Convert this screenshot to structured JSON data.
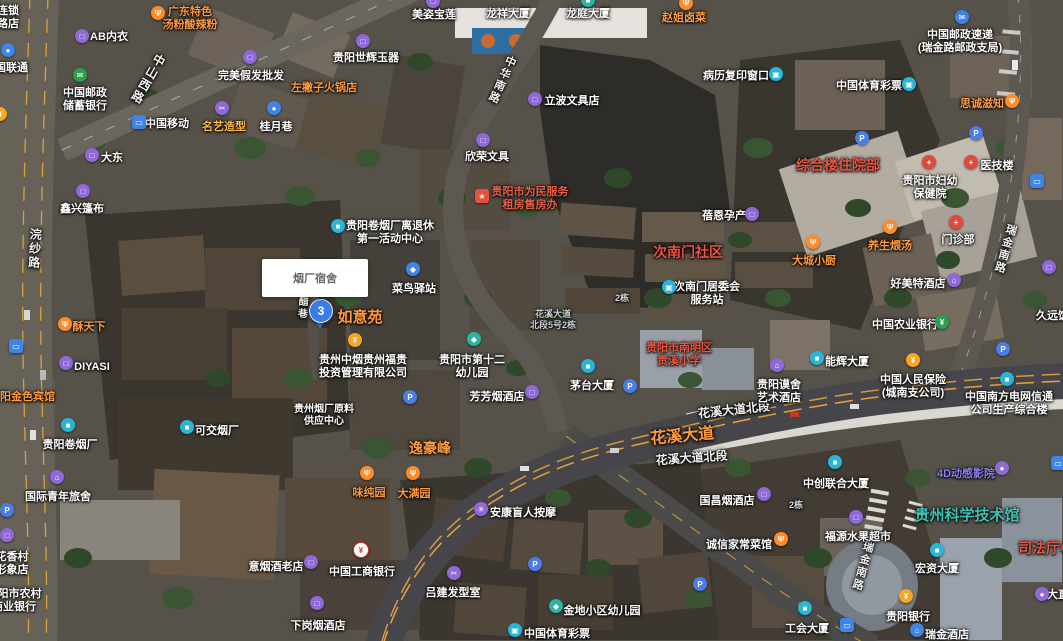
{
  "info_box": {
    "text": "烟厂宿舍"
  },
  "marker": {
    "label": "3"
  },
  "colors": {
    "poi_orange": "#ff9a3d",
    "area_red": "#e8543f",
    "science_teal": "#3cc2b4",
    "marker_blue": "#3a7de8",
    "road_orange": "#e8a23c"
  },
  "road_labels": [
    {
      "text": "中山西路",
      "x": 162,
      "y": 55,
      "rot": 30,
      "vert": true,
      "size": 12
    },
    {
      "text": "中华南路",
      "x": 512,
      "y": 56,
      "rot": 24,
      "vert": true,
      "size": 11
    },
    {
      "text": "浣纱路",
      "x": 36,
      "y": 228,
      "rot": 3,
      "vert": true,
      "size": 12
    },
    {
      "text": "酱醋巷",
      "x": 303,
      "y": 284,
      "rot": 4,
      "vert": true,
      "size": 10
    },
    {
      "text": "瑞金南路",
      "x": 1012,
      "y": 224,
      "rot": 16,
      "vert": true,
      "size": 11
    },
    {
      "text": "瑞金南路",
      "x": 869,
      "y": 541,
      "rot": 15,
      "vert": true,
      "size": 11
    },
    {
      "text": "花溪大道北段",
      "x": 733,
      "y": 401,
      "rot": -6,
      "vert": false,
      "size": 12
    },
    {
      "text": "花溪大道",
      "x": 681,
      "y": 422,
      "rot": -5,
      "vert": false,
      "size": 16,
      "color": "#ff9a3d"
    },
    {
      "text": "花溪大道北段",
      "x": 691,
      "y": 449,
      "rot": -4,
      "vert": false,
      "size": 12
    }
  ],
  "pois": [
    {
      "t": [
        "连锁",
        "路店"
      ],
      "x": 8,
      "y": 5
    },
    {
      "t": [
        "AB内衣"
      ],
      "x": 109,
      "y": 31,
      "icon": {
        "g": "□",
        "bg": "#9068d8",
        "x": 82,
        "y": 36
      }
    },
    {
      "t": [
        "广东特色",
        "汤粉酸辣粉"
      ],
      "x": 190,
      "y": 6,
      "c": "#ff9a3d",
      "icon": {
        "g": "Ψ",
        "bg": "#ff8c28",
        "x": 158,
        "y": 13
      }
    },
    {
      "t": [
        "中国联通"
      ],
      "x": 6,
      "y": 62,
      "icon": {
        "g": "●",
        "bg": "#3f85e8",
        "x": 8,
        "y": 50
      }
    },
    {
      "t": [
        "中国邮政",
        "储蓄银行"
      ],
      "x": 85,
      "y": 87,
      "icon": {
        "g": "✉",
        "bg": "#2e9e4f",
        "x": 80,
        "y": 75
      }
    },
    {
      "t": [
        "大东"
      ],
      "x": 112,
      "y": 152,
      "icon": {
        "g": "□",
        "bg": "#9068d8",
        "x": 92,
        "y": 155
      }
    },
    {
      "t": [
        "鑫兴篷布"
      ],
      "x": 82,
      "y": 203,
      "icon": {
        "g": "□",
        "bg": "#9068d8",
        "x": 83,
        "y": 191
      }
    },
    {
      "t": [
        "完美假发批发"
      ],
      "x": 251,
      "y": 70,
      "icon": {
        "g": "□",
        "bg": "#9068d8",
        "x": 250,
        "y": 57
      }
    },
    {
      "t": [
        "左撇子火锅店"
      ],
      "x": 324,
      "y": 82,
      "c": "#ff9a3d"
    },
    {
      "t": [
        "名艺造型"
      ],
      "x": 224,
      "y": 121,
      "c": "#ffb84a",
      "icon": {
        "g": "✂",
        "bg": "#9068d8",
        "x": 222,
        "y": 108
      }
    },
    {
      "t": [
        "桂月巷"
      ],
      "x": 276,
      "y": 121,
      "icon": {
        "g": "●",
        "bg": "#3f85e8",
        "x": 274,
        "y": 108
      }
    },
    {
      "t": [
        "中国移动"
      ],
      "x": 167,
      "y": 118,
      "icon": {
        "g": "▭",
        "bg": "#3f85e8",
        "x": 139,
        "y": 122,
        "sq": true
      }
    },
    {
      "t": [
        "贵阳世辉玉器"
      ],
      "x": 366,
      "y": 52,
      "icon": {
        "g": "□",
        "bg": "#9068d8",
        "x": 363,
        "y": 41
      }
    },
    {
      "t": [
        "美姿宝莲"
      ],
      "x": 434,
      "y": 9,
      "icon": {
        "g": "□",
        "bg": "#9068d8",
        "x": 433,
        "y": 1
      }
    },
    {
      "t": [
        "龙祥大厦"
      ],
      "x": 508,
      "y": 8
    },
    {
      "t": [
        "龙庭大厦"
      ],
      "x": 588,
      "y": 8,
      "icon": {
        "g": "■",
        "bg": "#2bb3a3",
        "x": 588,
        "y": 0
      }
    },
    {
      "t": [
        "赵姐卤菜"
      ],
      "x": 684,
      "y": 12,
      "c": "#ff9a3d",
      "icon": {
        "g": "Ψ",
        "bg": "#ff8c28",
        "x": 686,
        "y": 3
      }
    },
    {
      "t": [
        "欣荣文具"
      ],
      "x": 487,
      "y": 151,
      "icon": {
        "g": "□",
        "bg": "#9068d8",
        "x": 483,
        "y": 140
      }
    },
    {
      "t": [
        "立波文具店"
      ],
      "x": 572,
      "y": 95,
      "icon": {
        "g": "□",
        "bg": "#9068d8",
        "x": 535,
        "y": 99
      }
    },
    {
      "t": [
        "病历复印窗口"
      ],
      "x": 736,
      "y": 70,
      "icon": {
        "g": "▣",
        "bg": "#2ab5d8",
        "x": 776,
        "y": 74
      }
    },
    {
      "t": [
        "中国邮政速递",
        "(瑞金路邮政支局)"
      ],
      "x": 960,
      "y": 29,
      "icon": {
        "g": "✉",
        "bg": "#3f85e8",
        "x": 962,
        "y": 17
      }
    },
    {
      "t": [
        "中国体育彩票"
      ],
      "x": 869,
      "y": 80,
      "icon": {
        "g": "▣",
        "bg": "#2ab5d8",
        "x": 909,
        "y": 84
      }
    },
    {
      "t": [
        "思诚滋知"
      ],
      "x": 982,
      "y": 98,
      "c": "#ff9a3d",
      "icon": {
        "g": "Ψ",
        "bg": "#ff8c28",
        "x": 1012,
        "y": 101
      }
    },
    {
      "icon": {
        "g": "P",
        "bg": "#4a7de8",
        "x": 862,
        "y": 138
      }
    },
    {
      "icon": {
        "g": "P",
        "bg": "#4a7de8",
        "x": 976,
        "y": 133
      }
    },
    {
      "t": [
        "综合楼住院部"
      ],
      "x": 838,
      "y": 157,
      "c": "#e8543f",
      "s": 14
    },
    {
      "t": [
        "贵阳市妇幼",
        "保健院"
      ],
      "x": 930,
      "y": 175,
      "icon": {
        "g": "+",
        "bg": "#e2483c",
        "x": 929,
        "y": 162
      }
    },
    {
      "t": [
        "医技楼"
      ],
      "x": 997,
      "y": 160,
      "icon": {
        "g": "+",
        "bg": "#e2483c",
        "x": 971,
        "y": 162
      }
    },
    {
      "t": [
        "蓓恩孕产"
      ],
      "x": 724,
      "y": 210,
      "icon": {
        "g": "□",
        "bg": "#9068d8",
        "x": 752,
        "y": 214
      }
    },
    {
      "t": [
        "次南门社区"
      ],
      "x": 688,
      "y": 244,
      "c": "#e8543f",
      "s": 14
    },
    {
      "t": [
        "大城小厨"
      ],
      "x": 814,
      "y": 255,
      "c": "#ff9a3d",
      "icon": {
        "g": "Ψ",
        "bg": "#ff8c28",
        "x": 813,
        "y": 242
      }
    },
    {
      "t": [
        "养生煨汤"
      ],
      "x": 890,
      "y": 240,
      "c": "#ff9a3d",
      "icon": {
        "g": "Ψ",
        "bg": "#ff8c28",
        "x": 890,
        "y": 227
      }
    },
    {
      "t": [
        "门诊部"
      ],
      "x": 958,
      "y": 234,
      "icon": {
        "g": "+",
        "bg": "#e2483c",
        "x": 956,
        "y": 222
      }
    },
    {
      "t": [
        "好美特酒店"
      ],
      "x": 918,
      "y": 278,
      "icon": {
        "g": "⌂",
        "bg": "#9068d8",
        "x": 954,
        "y": 280
      }
    },
    {
      "t": [
        "久远饭店"
      ],
      "x": 1058,
      "y": 310
    },
    {
      "icon": {
        "g": "▭",
        "bg": "#3f85e8",
        "x": 1037,
        "y": 181,
        "sq": true
      }
    },
    {
      "icon": {
        "g": "□",
        "bg": "#9068d8",
        "x": 1049,
        "y": 267
      }
    },
    {
      "t": [
        "贵阳市为民服务",
        "租房售房办"
      ],
      "x": 530,
      "y": 186,
      "c": "#e8604a",
      "icon": {
        "g": "★",
        "bg": "#e8503e",
        "x": 482,
        "y": 196,
        "sq": true
      }
    },
    {
      "t": [
        "贵阳卷烟厂离退休",
        "第一活动中心"
      ],
      "x": 390,
      "y": 220,
      "icon": {
        "g": "■",
        "bg": "#2ab5d8",
        "x": 338,
        "y": 226
      }
    },
    {
      "t": [
        "次南门居委会",
        "服务站"
      ],
      "x": 707,
      "y": 281,
      "icon": {
        "g": "▣",
        "bg": "#2ab5d8",
        "x": 669,
        "y": 287
      }
    },
    {
      "t": [
        "菜鸟驿站"
      ],
      "x": 414,
      "y": 283,
      "icon": {
        "g": "◆",
        "bg": "#3f85e8",
        "x": 413,
        "y": 269
      }
    },
    {
      "t": [
        "如意苑"
      ],
      "x": 360,
      "y": 309,
      "c": "#ff9a3d",
      "s": 15
    },
    {
      "t": [
        "贵州中烟贵州福贵",
        "投资管理有限公司"
      ],
      "x": 363,
      "y": 354,
      "icon": {
        "g": "¥",
        "bg": "#f5a623",
        "x": 355,
        "y": 340
      }
    },
    {
      "t": [
        "贵阳市第十二",
        "幼儿园"
      ],
      "x": 472,
      "y": 354,
      "icon": {
        "g": "◆",
        "bg": "#2bb3a3",
        "x": 474,
        "y": 339
      }
    },
    {
      "t": [
        "芳芳烟酒店"
      ],
      "x": 497,
      "y": 391,
      "icon": {
        "g": "□",
        "bg": "#9068d8",
        "x": 532,
        "y": 392
      }
    },
    {
      "t": [
        "茅台大厦"
      ],
      "x": 592,
      "y": 380,
      "icon": {
        "g": "■",
        "bg": "#2ab5d8",
        "x": 588,
        "y": 366
      }
    },
    {
      "t": [
        "贵阳市南明区",
        "贵溪小学"
      ],
      "x": 679,
      "y": 342,
      "c": "#e8543f"
    },
    {
      "icon": {
        "g": "P",
        "bg": "#4a7de8",
        "x": 410,
        "y": 397
      }
    },
    {
      "icon": {
        "g": "P",
        "bg": "#4a7de8",
        "x": 630,
        "y": 386
      }
    },
    {
      "t": [
        "逸豪峰"
      ],
      "x": 430,
      "y": 440,
      "c": "#ff9a3d",
      "s": 14
    },
    {
      "t": [
        "贵州烟厂原料",
        "供应中心"
      ],
      "x": 324,
      "y": 404,
      "s": 10
    },
    {
      "t": [
        "味纯园"
      ],
      "x": 369,
      "y": 487,
      "c": "#ff9a3d",
      "icon": {
        "g": "Ψ",
        "bg": "#ff8c28",
        "x": 367,
        "y": 473
      }
    },
    {
      "t": [
        "大满园"
      ],
      "x": 414,
      "y": 488,
      "c": "#ff9a3d",
      "icon": {
        "g": "Ψ",
        "bg": "#ff8c28",
        "x": 413,
        "y": 473
      }
    },
    {
      "t": [
        "中国农业银行"
      ],
      "x": 905,
      "y": 319,
      "icon": {
        "g": "¥",
        "bg": "#2e9e4f",
        "x": 942,
        "y": 322
      }
    },
    {
      "t": [
        "能辉大厦"
      ],
      "x": 847,
      "y": 356,
      "icon": {
        "g": "■",
        "bg": "#2ab5d8",
        "x": 817,
        "y": 358
      }
    },
    {
      "t": [
        "贵阳谟舍",
        "艺术酒店"
      ],
      "x": 779,
      "y": 379,
      "icon": {
        "g": "⌂",
        "bg": "#9068d8",
        "x": 777,
        "y": 365
      }
    },
    {
      "t": [
        "中国人民保险",
        "(城南支公司)"
      ],
      "x": 913,
      "y": 374,
      "icon": {
        "g": "¥",
        "bg": "#f5a623",
        "x": 913,
        "y": 360
      }
    },
    {
      "t": [
        "中国南方电网信通",
        "公司生产综合楼"
      ],
      "x": 1009,
      "y": 391
    },
    {
      "icon": {
        "g": "P",
        "bg": "#4a7de8",
        "x": 1003,
        "y": 349
      }
    },
    {
      "icon": {
        "g": "■",
        "bg": "#2ab5d8",
        "x": 1007,
        "y": 379
      }
    },
    {
      "t": [
        "中创联合大厦"
      ],
      "x": 836,
      "y": 478,
      "icon": {
        "g": "■",
        "bg": "#2ab5d8",
        "x": 835,
        "y": 462
      }
    },
    {
      "t": [
        "4D动感影院"
      ],
      "x": 966,
      "y": 468,
      "c": "#8b7ce8",
      "icon": {
        "g": "●",
        "bg": "#9068d8",
        "x": 1002,
        "y": 468
      }
    },
    {
      "icon": {
        "g": "▭",
        "bg": "#3f85e8",
        "x": 1058,
        "y": 463,
        "sq": true
      }
    },
    {
      "t": [
        "酥天下"
      ],
      "x": 89,
      "y": 321,
      "c": "#ff9a3d",
      "icon": {
        "g": "Ψ",
        "bg": "#ff8c28",
        "x": 65,
        "y": 324
      }
    },
    {
      "t": [
        "DIYASI"
      ],
      "x": 92,
      "y": 361,
      "icon": {
        "g": "□",
        "bg": "#9068d8",
        "x": 66,
        "y": 363
      }
    },
    {
      "t": [
        "贵阳金色宾馆"
      ],
      "x": 22,
      "y": 391,
      "c": "#ff9a3d"
    },
    {
      "t": [
        "贵阳卷烟厂"
      ],
      "x": 70,
      "y": 439,
      "icon": {
        "g": "■",
        "bg": "#2ab5d8",
        "x": 68,
        "y": 425
      }
    },
    {
      "t": [
        "可交烟厂"
      ],
      "x": 217,
      "y": 425,
      "icon": {
        "g": "■",
        "bg": "#2ab5d8",
        "x": 187,
        "y": 427
      }
    },
    {
      "t": [
        "国际青年旅舍"
      ],
      "x": 58,
      "y": 491,
      "icon": {
        "g": "⌂",
        "bg": "#9068d8",
        "x": 57,
        "y": 477
      }
    },
    {
      "icon": {
        "g": "P",
        "bg": "#4a7de8",
        "x": 7,
        "y": 510
      }
    },
    {
      "icon": {
        "g": "¥",
        "bg": "#f5a623",
        "x": 0,
        "y": 114
      }
    },
    {
      "icon": {
        "g": "▭",
        "bg": "#3f85e8",
        "x": 16,
        "y": 346,
        "sq": true
      }
    },
    {
      "t": [
        "花香村",
        "形象店"
      ],
      "x": 12,
      "y": 551,
      "icon": {
        "g": "□",
        "bg": "#9068d8",
        "x": 7,
        "y": 535
      }
    },
    {
      "t": [
        "贵阳市农村",
        "商业银行"
      ],
      "x": 14,
      "y": 588
    },
    {
      "t": [
        "意烟酒老店"
      ],
      "x": 276,
      "y": 561,
      "icon": {
        "g": "□",
        "bg": "#9068d8",
        "x": 311,
        "y": 562
      }
    },
    {
      "t": [
        "中国工商银行"
      ],
      "x": 362,
      "y": 566,
      "icon": {
        "g": "¥",
        "bg": "#ffffff",
        "fg": "#d83a2e",
        "x": 361,
        "y": 550
      }
    },
    {
      "t": [
        "下岗烟酒店"
      ],
      "x": 318,
      "y": 620,
      "icon": {
        "g": "□",
        "bg": "#9068d8",
        "x": 317,
        "y": 603
      }
    },
    {
      "t": [
        "安康盲人按摩"
      ],
      "x": 523,
      "y": 507,
      "icon": {
        "g": "✳",
        "bg": "#9068d8",
        "x": 481,
        "y": 509
      }
    },
    {
      "t": [
        "吕建发型室"
      ],
      "x": 453,
      "y": 587,
      "icon": {
        "g": "✂",
        "bg": "#9068d8",
        "x": 454,
        "y": 573
      }
    },
    {
      "icon": {
        "g": "P",
        "bg": "#4a7de8",
        "x": 535,
        "y": 564
      }
    },
    {
      "icon": {
        "g": "P",
        "bg": "#4a7de8",
        "x": 700,
        "y": 584
      }
    },
    {
      "t": [
        "金地小区幼儿园"
      ],
      "x": 602,
      "y": 605,
      "icon": {
        "g": "◆",
        "bg": "#2bb3a3",
        "x": 556,
        "y": 606
      }
    },
    {
      "t": [
        "中国体育彩票"
      ],
      "x": 557,
      "y": 628,
      "icon": {
        "g": "▣",
        "bg": "#2ab5d8",
        "x": 515,
        "y": 630
      }
    },
    {
      "t": [
        "国昌烟酒店"
      ],
      "x": 727,
      "y": 495,
      "icon": {
        "g": "□",
        "bg": "#9068d8",
        "x": 764,
        "y": 494
      }
    },
    {
      "t": [
        "诚信家常菜馆"
      ],
      "x": 739,
      "y": 539,
      "icon": {
        "g": "Ψ",
        "bg": "#ff8c28",
        "x": 781,
        "y": 539
      }
    },
    {
      "t": [
        "福源水果超市"
      ],
      "x": 858,
      "y": 531,
      "icon": {
        "g": "□",
        "bg": "#9068d8",
        "x": 856,
        "y": 517
      }
    },
    {
      "t": [
        "贵州科学技术馆"
      ],
      "x": 967,
      "y": 507,
      "c": "#3cc2b4",
      "s": 15
    },
    {
      "t": [
        "司法厅小区"
      ],
      "x": 1053,
      "y": 540,
      "c": "#e8543f",
      "s": 14
    },
    {
      "t": [
        "宏资大厦"
      ],
      "x": 937,
      "y": 563,
      "icon": {
        "g": "■",
        "bg": "#2ab5d8",
        "x": 937,
        "y": 550
      }
    },
    {
      "t": [
        "贵阳银行"
      ],
      "x": 908,
      "y": 611,
      "icon": {
        "g": "¥",
        "bg": "#f5a623",
        "x": 906,
        "y": 596
      }
    },
    {
      "t": [
        "瑞金酒店"
      ],
      "x": 947,
      "y": 629,
      "icon": {
        "g": "⌂",
        "bg": "#3f85e8",
        "x": 917,
        "y": 630
      }
    },
    {
      "t": [
        "工会大厦"
      ],
      "x": 807,
      "y": 623,
      "icon": {
        "g": "■",
        "bg": "#2ab5d8",
        "x": 805,
        "y": 608
      }
    },
    {
      "icon": {
        "g": "▭",
        "bg": "#3f85e8",
        "x": 847,
        "y": 625,
        "sq": true
      }
    },
    {
      "t": [
        "大直"
      ],
      "x": 1058,
      "y": 589,
      "icon": {
        "g": "●",
        "bg": "#9068d8",
        "x": 1042,
        "y": 594
      }
    },
    {
      "t": [
        "2栋"
      ],
      "x": 622,
      "y": 293,
      "s": 9,
      "c": "#d8dce0"
    },
    {
      "t": [
        "2栋"
      ],
      "x": 796,
      "y": 500,
      "s": 9,
      "c": "#d8dce0"
    },
    {
      "t": [
        "花溪大道",
        "北段5号2栋"
      ],
      "x": 553,
      "y": 309,
      "s": 9,
      "c": "#c9ced4"
    }
  ]
}
